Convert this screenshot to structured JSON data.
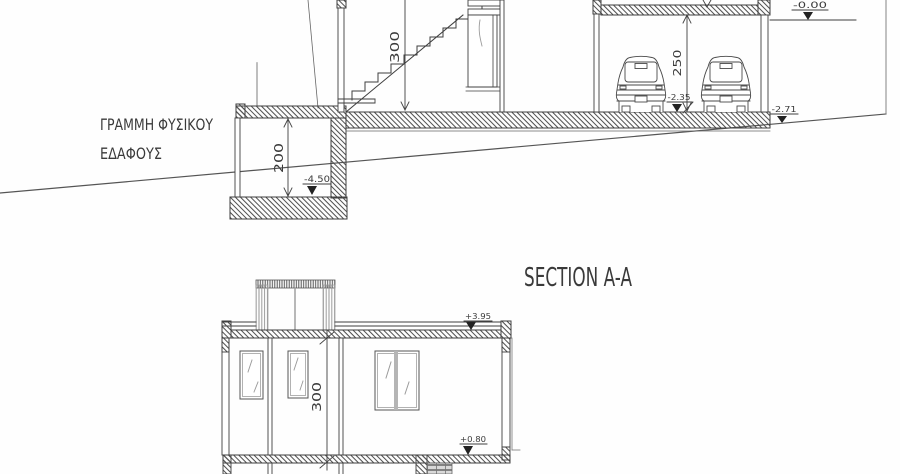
{
  "drawing": {
    "title": "SECTION A-A",
    "ground_label": {
      "line1": "ΓΡΑΜΜΗ ΦΥΣΙΚΟΥ",
      "line2": "ΕΔΑΦΟΥΣ"
    },
    "upper": {
      "dim_stairs": "300",
      "dim_garage": "250",
      "dim_basement": "200",
      "lvl_zero": "-0.00",
      "lvl_garage_floor": "-2.35",
      "lvl_ground_right": "-2.71",
      "lvl_basement": "-4.50"
    },
    "lower": {
      "dim_floor": "300",
      "lvl_roof": "+3.95",
      "lvl_floor": "+0.80"
    },
    "colors": {
      "line": "#3f3f3f",
      "light_line": "#9a9a9a",
      "text": "#333333"
    }
  }
}
